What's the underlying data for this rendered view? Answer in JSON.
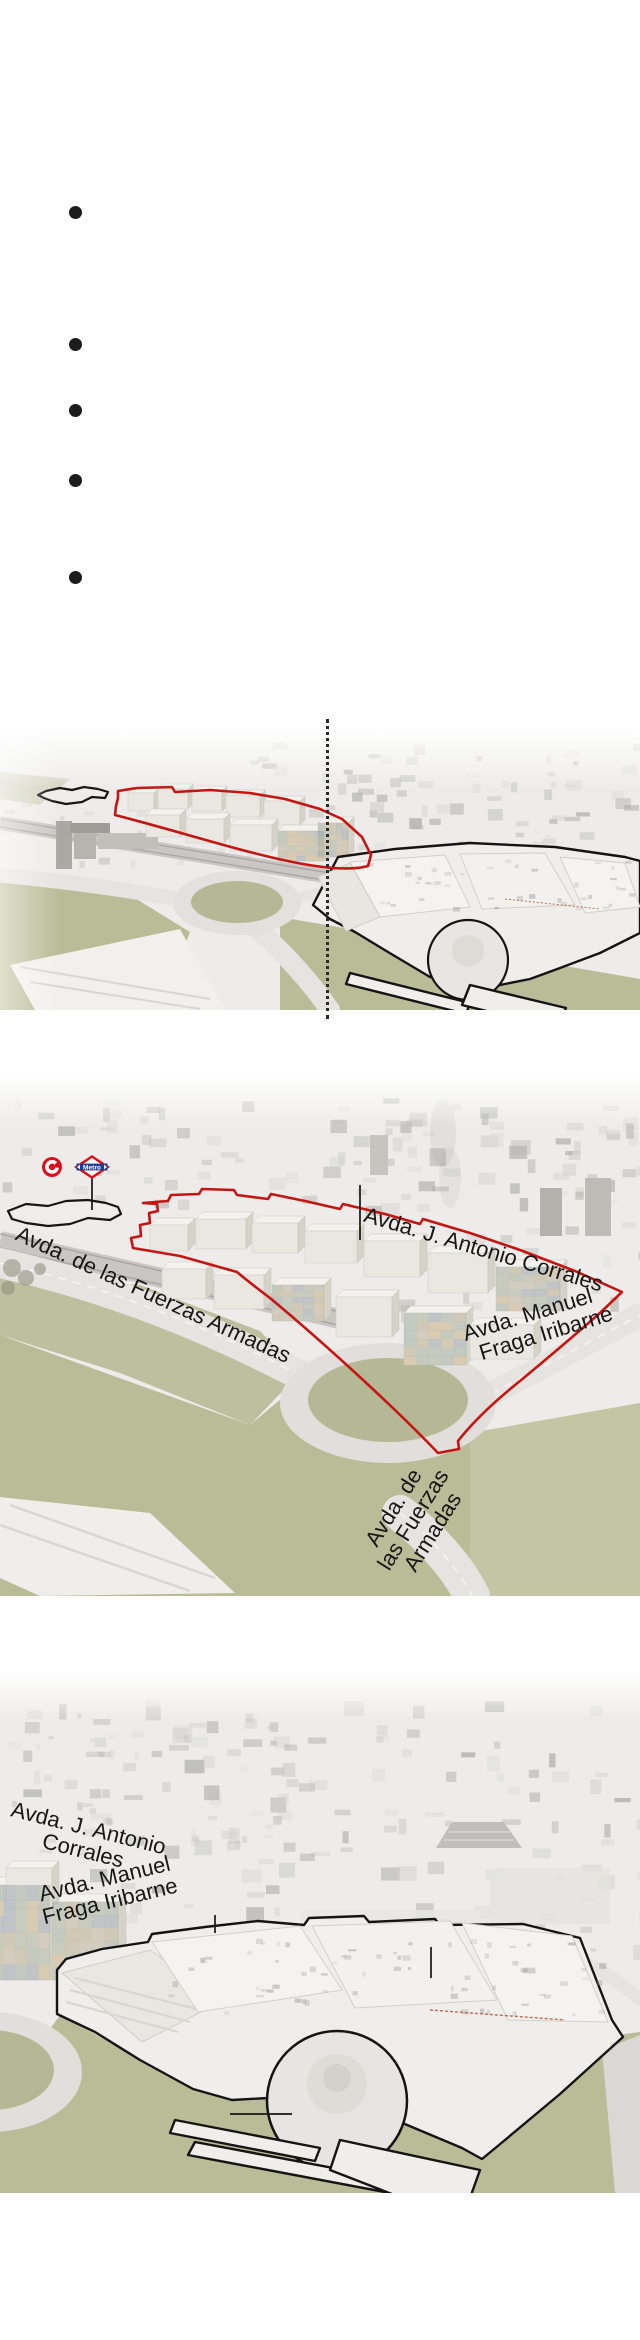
{
  "document": {
    "background": "#ffffff",
    "description": "Newspaper-style infographic: bulleted list followed by three annotated aerial photographs of a planned development (red outline) beside an existing shopping centre (black outline) in Madrid"
  },
  "bullet_list": {
    "bullet_count": 5,
    "items": [
      "",
      "",
      "",
      "",
      ""
    ]
  },
  "figures": {
    "aerial_1": {
      "description": "Wide aerial view: development site outlined in red (left) and shopping centre outlined in black (right), split by a vertical dotted divider",
      "street_labels": {}
    },
    "aerial_2": {
      "description": "Close aerial view of the red-outlined development site with street annotations, Metro and Cercanias markers and roundabout",
      "street_labels": {
        "fuerzas_armadas_diagonal": "Avda. de las Fuerzas Armadas",
        "antonio_corrales": "Avda. J. Antonio Corrales",
        "manuel_fraga_line1": "Avda. Manuel",
        "manuel_fraga_line2": "Fraga Iribarne",
        "fuerzas_armadas_road_line1": "Avda. de",
        "fuerzas_armadas_road_line2": "las Fuerzas",
        "fuerzas_armadas_road_line3": "Armadas"
      },
      "metro_logo_text": "Metro"
    },
    "aerial_3": {
      "description": "Close aerial view of the black-outlined shopping centre with dome, with street annotations",
      "street_labels": {
        "antonio_corrales_line1": "Avda. J. Antonio",
        "antonio_corrales_line2": "Corrales",
        "manuel_fraga_line1": "Avda. Manuel",
        "manuel_fraga_line2": "Fraga Iribarne"
      }
    }
  },
  "colors": {
    "outline_red": "#c61511",
    "annotation_black": "#171717",
    "field_green": "#b9bc97",
    "field_green_light": "#c6c8a6",
    "photo_base": "#edecea",
    "metro_red": "#dc1019",
    "metro_blue": "#223a8f",
    "cercanias_red": "#d8121c",
    "roof_red_line": "#b04a30"
  }
}
